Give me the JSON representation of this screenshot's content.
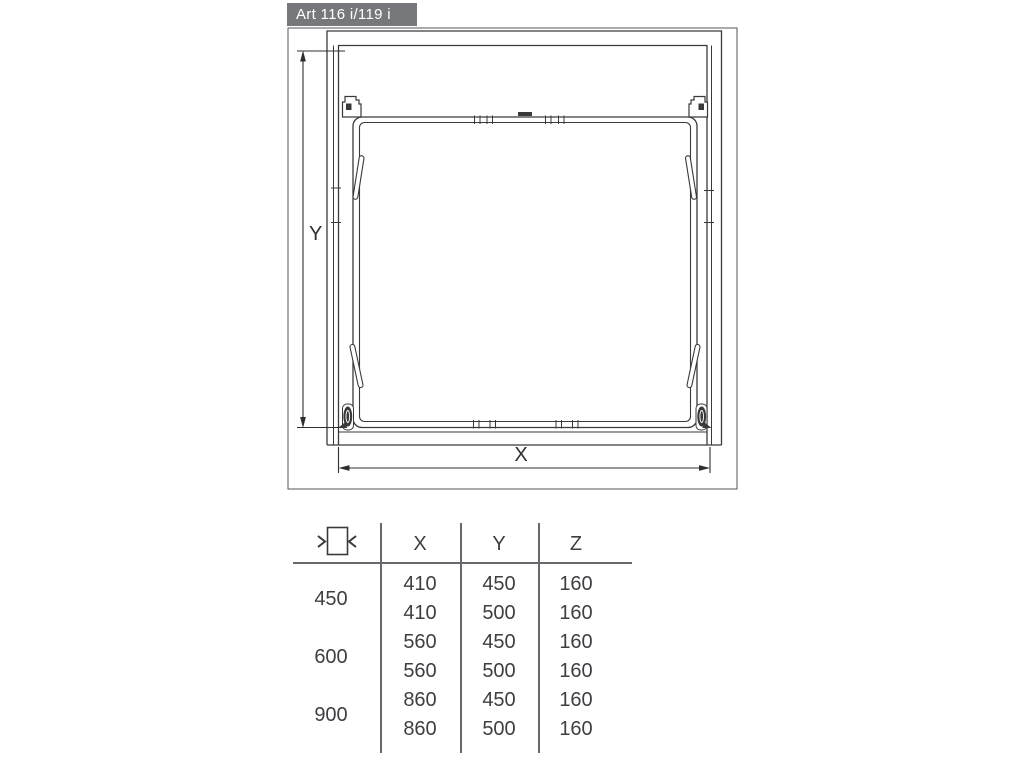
{
  "drawing": {
    "title": "Art 116 i/119 i",
    "title_bg": "#77787c",
    "line_color": "#3a3a3a",
    "x_label": "X",
    "y_label": "Y"
  },
  "table": {
    "size_icon": "cabinet-width-icon",
    "columns": [
      "X",
      "Y",
      "Z"
    ],
    "groups": [
      {
        "label": "450",
        "rows": [
          [
            "410",
            "450",
            "160"
          ],
          [
            "410",
            "500",
            "160"
          ]
        ]
      },
      {
        "label": "600",
        "rows": [
          [
            "560",
            "450",
            "160"
          ],
          [
            "560",
            "500",
            "160"
          ]
        ]
      },
      {
        "label": "900",
        "rows": [
          [
            "860",
            "450",
            "160"
          ],
          [
            "860",
            "500",
            "160"
          ]
        ]
      }
    ]
  }
}
